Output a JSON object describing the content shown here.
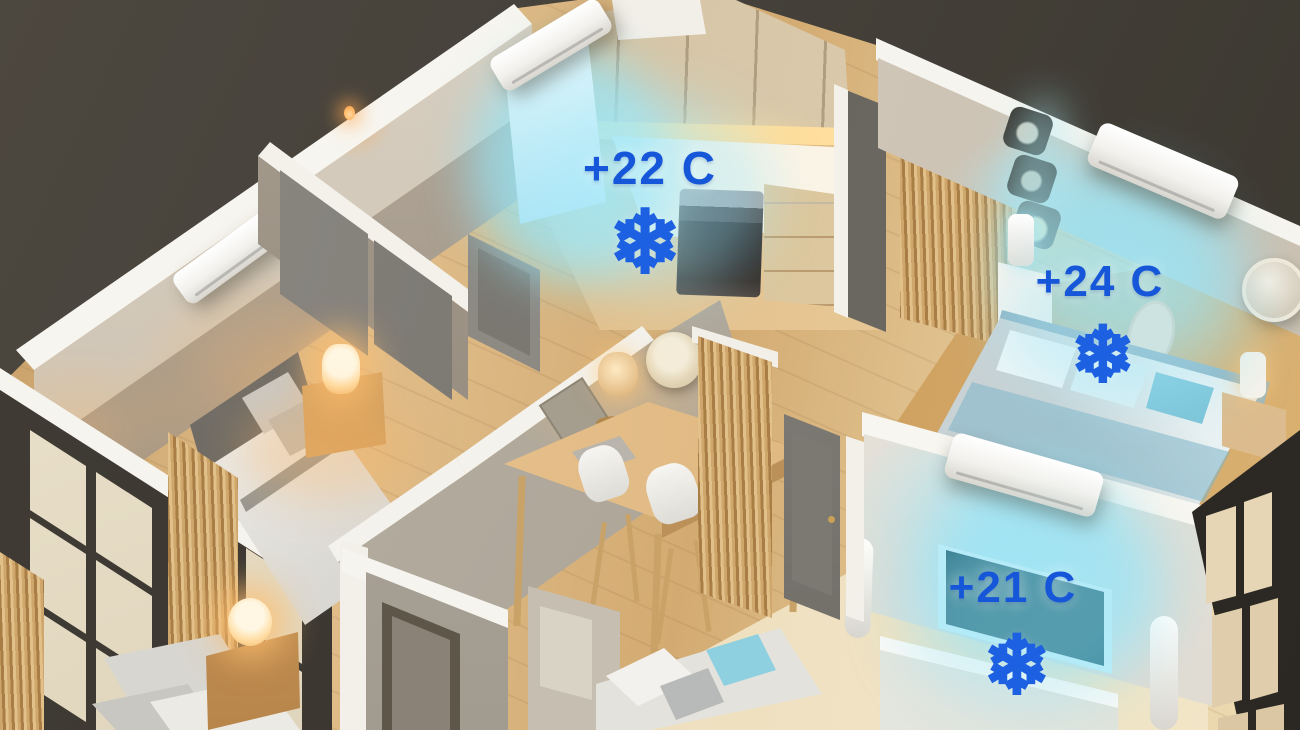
{
  "scene": {
    "type": "isometric-apartment-climate-render",
    "snowflake_glyph": "❄",
    "colors": {
      "background": "#45413a",
      "temperature_text": "#1557d8",
      "snowflake": "#1d61e2",
      "cool_air_glow": "#9fe4f4",
      "warm_light": "#ffc37a",
      "wall": "#d2c9bb",
      "wood_floor": "#ddb988"
    },
    "rooms": [
      {
        "name": "kitchen",
        "temperature_label": "+22 C",
        "icon": "snowflake-icon",
        "has_ac_unit": true
      },
      {
        "name": "bedroom-right",
        "temperature_label": "+24 C",
        "icon": "snowflake-icon",
        "has_ac_unit": true
      },
      {
        "name": "living-room",
        "temperature_label": "+21 C",
        "icon": "snowflake-icon",
        "has_ac_unit": true
      },
      {
        "name": "bedroom-left",
        "temperature_label": "",
        "icon": "",
        "has_ac_unit": true
      }
    ]
  }
}
